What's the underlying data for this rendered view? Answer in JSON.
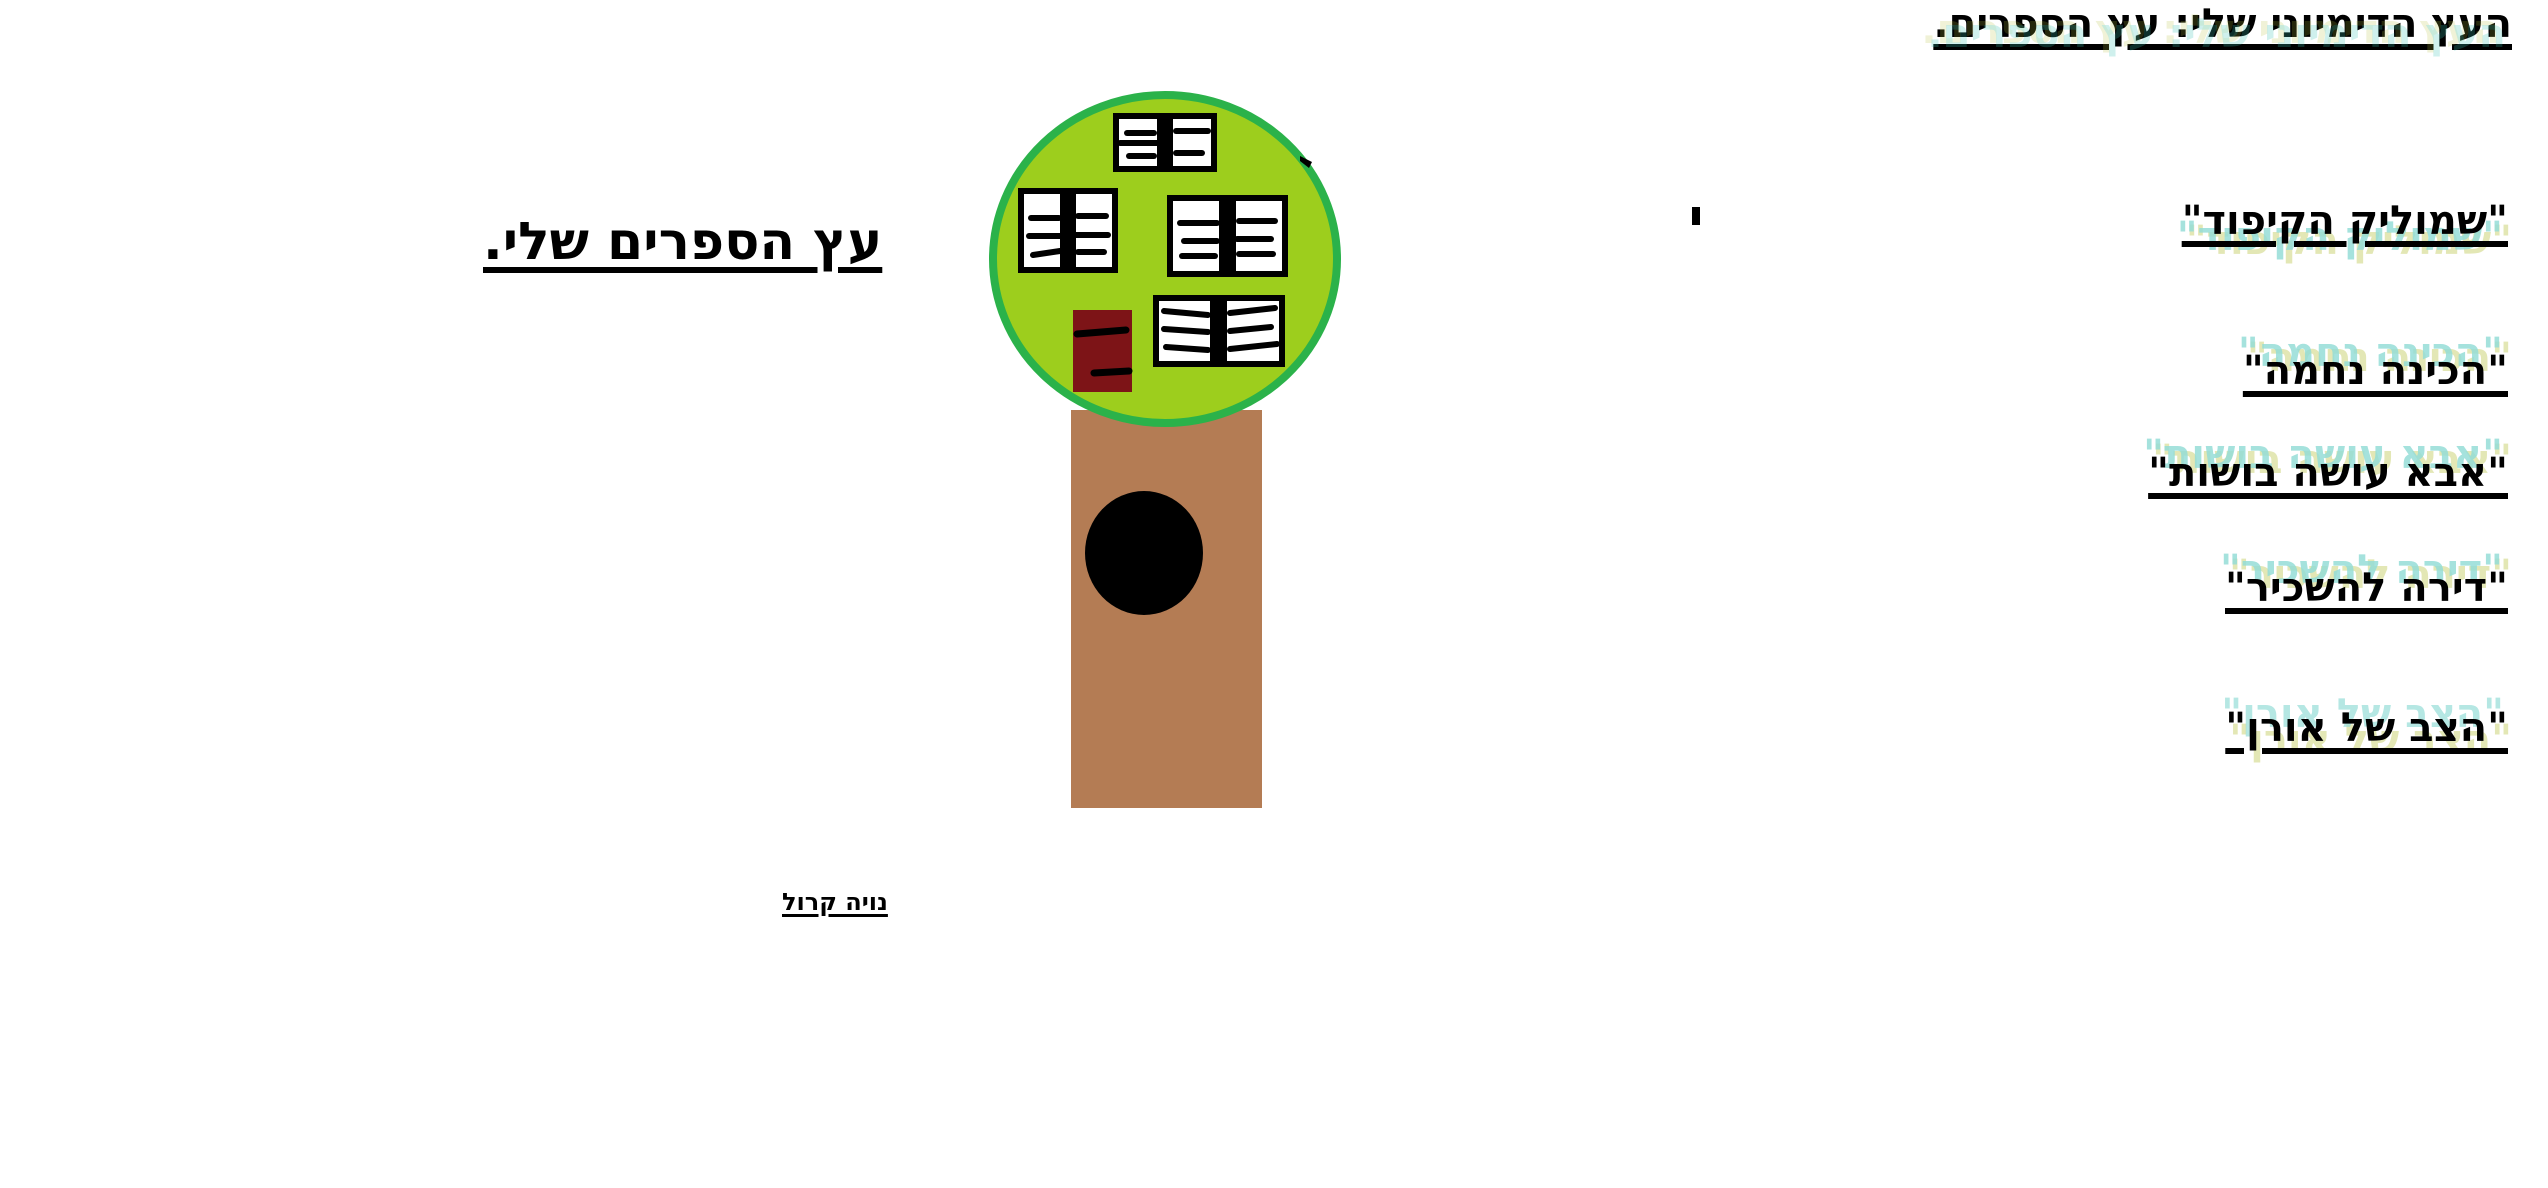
{
  "document": {
    "title": "העץ הדימיוני שלי: עץ הספרים.",
    "heading": "עץ הספרים שלי.",
    "books": [
      "\"שמוליק הקיפוד\"",
      "\"הכינה נחמה\"",
      "\"אבא עושה בושות\"",
      "\"דירה להשכיר\"",
      "\"הצב של אורן\""
    ],
    "author": "נויה קרול"
  },
  "tree": {
    "canopy_fill": "#9DCE1D",
    "canopy_stroke": "#2BB24A",
    "trunk_fill": "#B47C54",
    "hole_fill": "#000000",
    "book_page_fill": "#FFFFFF",
    "book_ink": "#000000",
    "red_book_fill": "#7D1417"
  },
  "artifacts": {
    "ghost_teal": "#3DC1B5",
    "ghost_olive": "#B6C03E"
  }
}
